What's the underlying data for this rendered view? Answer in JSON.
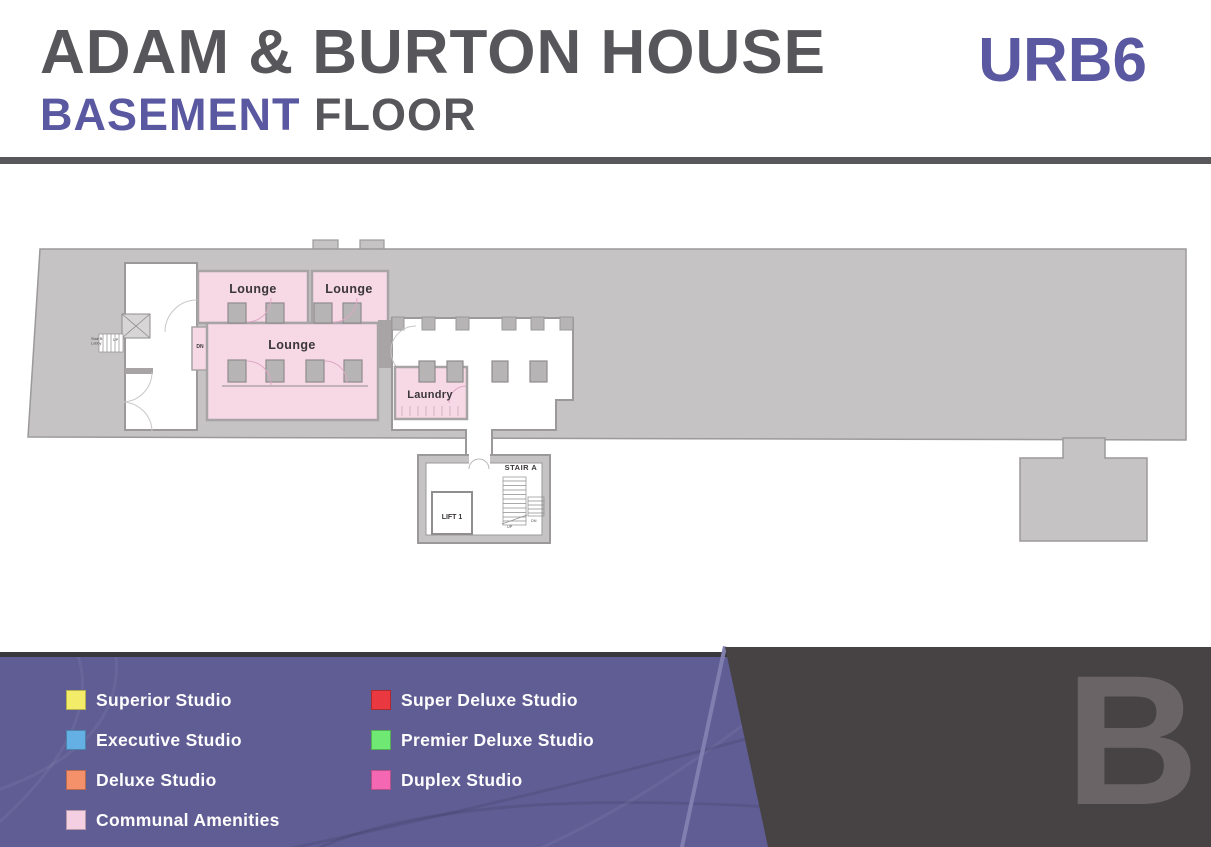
{
  "header": {
    "title": "ADAM & BURTON HOUSE",
    "floor_name": "BASEMENT",
    "floor_suffix": " FLOOR",
    "plan_code": "URB6"
  },
  "floor_plan": {
    "rooms": [
      {
        "name": "lounge-top-left",
        "label": "Lounge"
      },
      {
        "name": "lounge-top-right",
        "label": "Lounge"
      },
      {
        "name": "lounge-main",
        "label": "Lounge"
      },
      {
        "name": "laundry",
        "label": "Laundry"
      },
      {
        "name": "stair-a",
        "label": "STAIR A"
      },
      {
        "name": "lift-1",
        "label": "LIFT 1"
      }
    ],
    "annotations": {
      "dn": "DN",
      "stair_lobby_line1": "Stair B",
      "stair_lobby_line2": "Lobby",
      "lobby_up": "UP",
      "stair_up": "UP",
      "stair_dn": "DN"
    }
  },
  "legend": {
    "column1": [
      {
        "label": "Superior Studio",
        "color": "#f2ec68"
      },
      {
        "label": "Executive Studio",
        "color": "#64b0e4"
      },
      {
        "label": "Deluxe Studio",
        "color": "#f4906a"
      },
      {
        "label": "Communal Amenities",
        "color": "#f3cfe1"
      }
    ],
    "column2": [
      {
        "label": "Super Deluxe Studio",
        "color": "#e9383f"
      },
      {
        "label": "Premier Deluxe Studio",
        "color": "#6fe973"
      },
      {
        "label": "Duplex Studio",
        "color": "#f468b3"
      }
    ]
  },
  "watermark": "B",
  "colors": {
    "accent_purple": "#5a58a0",
    "title_gray": "#57575b",
    "panel_purple": "#5f5d94",
    "panel_dark": "#474344",
    "plan_gray": "#c5c3c4",
    "plan_wall": "#9b999a",
    "room_pink": "#f7d9e6",
    "watermark_gray": "#6a6467"
  }
}
